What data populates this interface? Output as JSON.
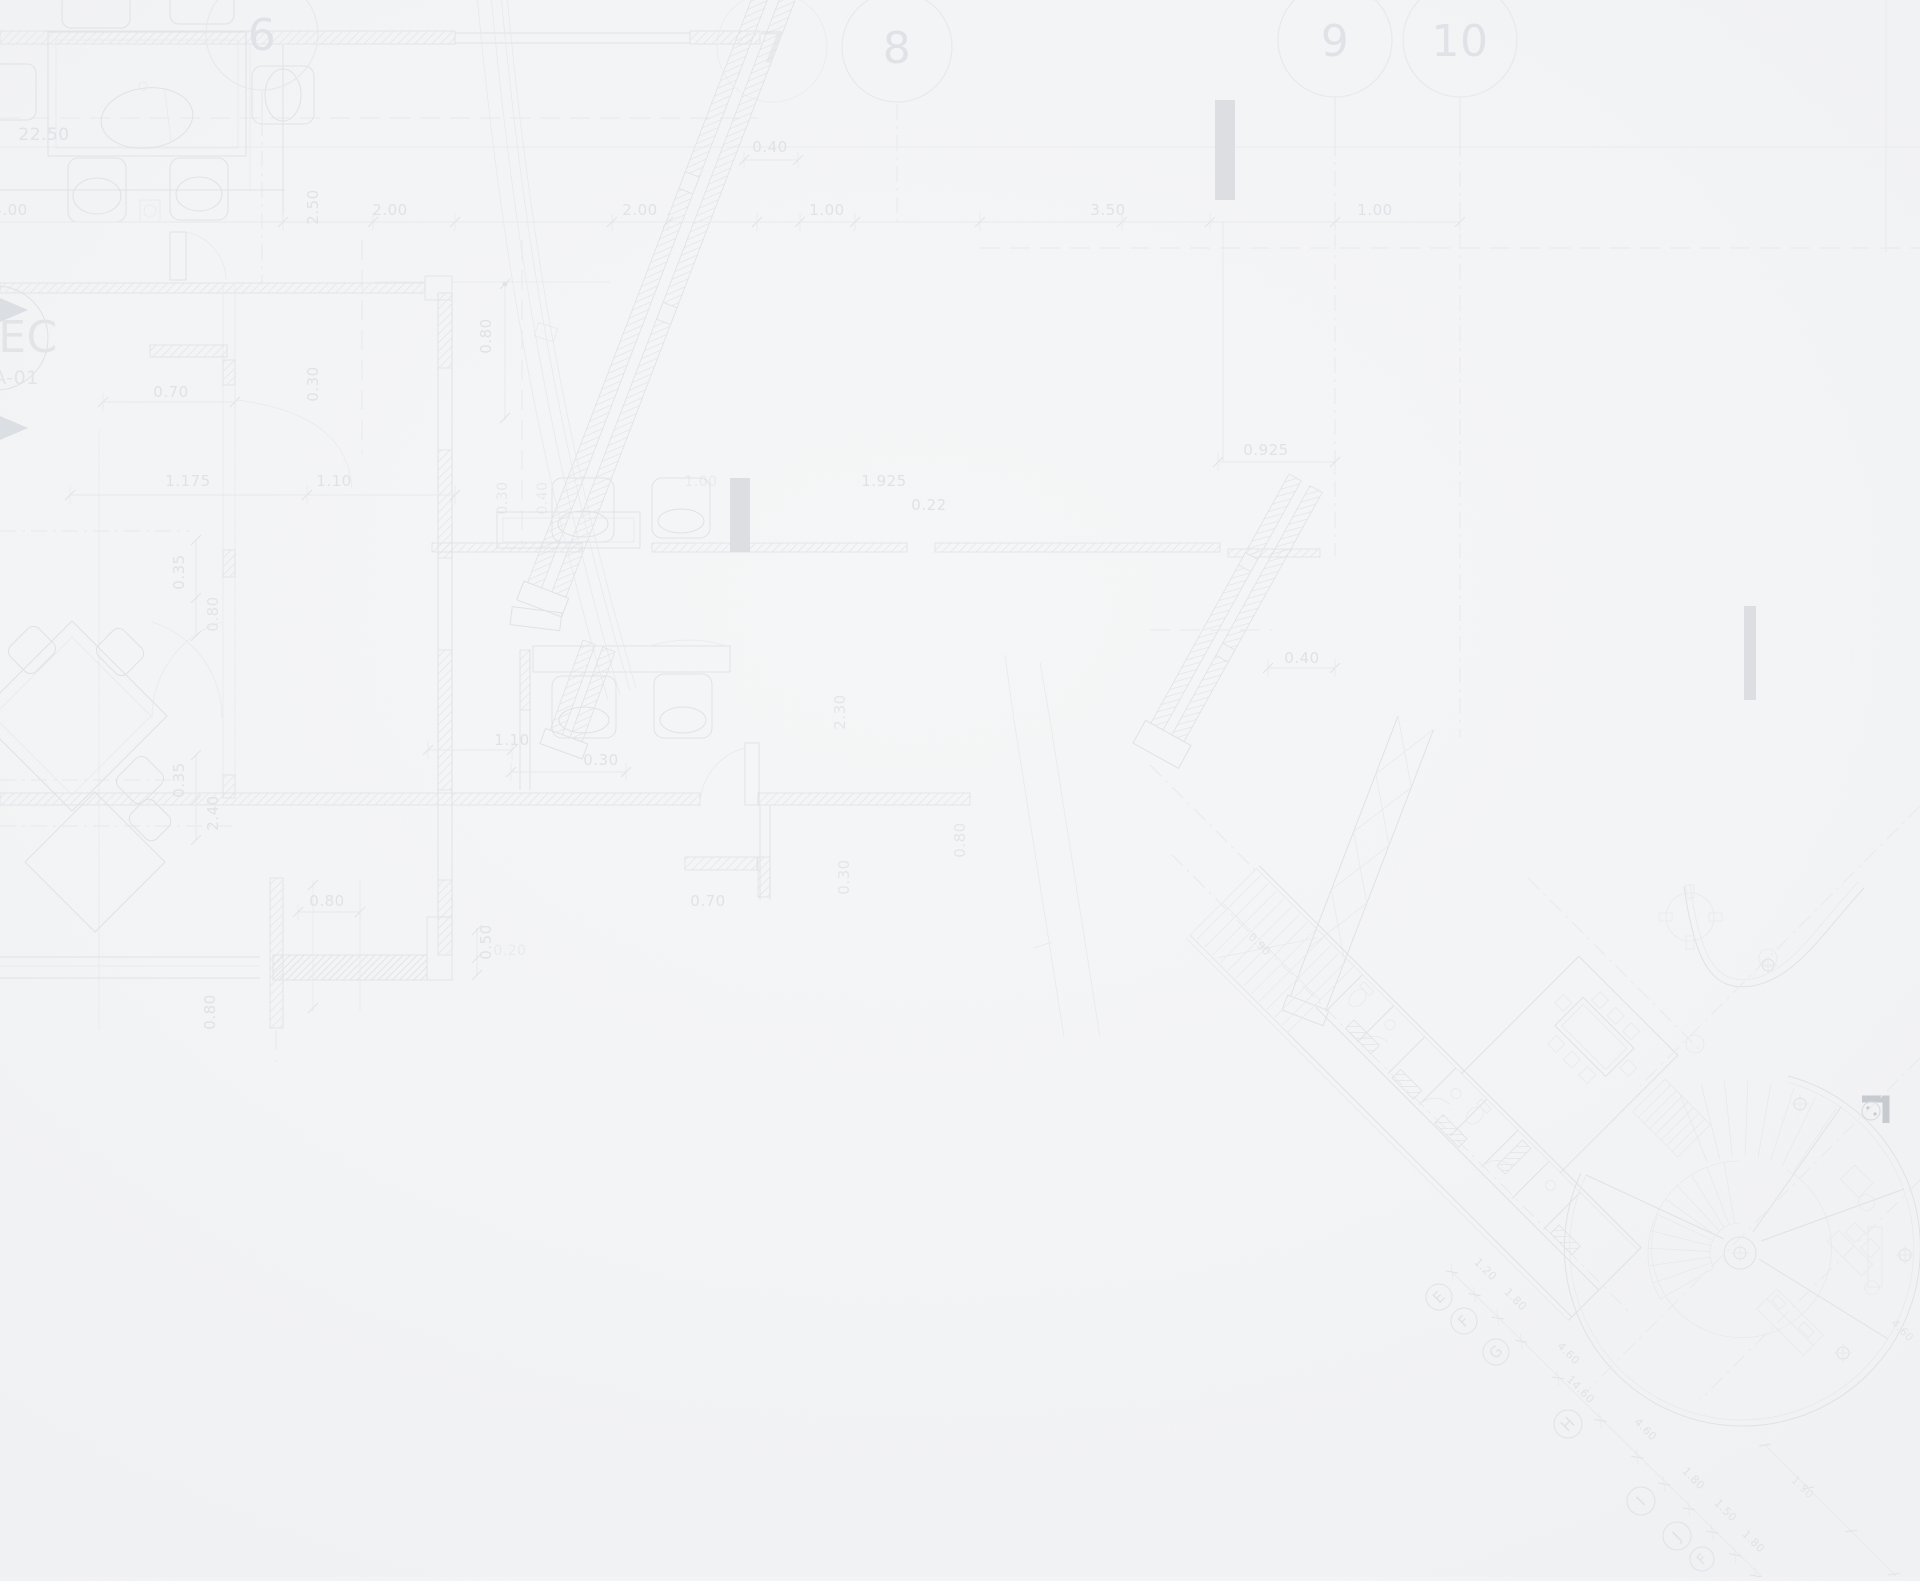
{
  "document": {
    "title": "Architectural floor plan blueprint background",
    "section_marker": {
      "line1": "EC",
      "line2": "A-01"
    }
  },
  "colors": {
    "background": "#f3f4f5",
    "line_light": "#e7e9ec",
    "line_mid": "#dfe2e6",
    "line_dark": "#d9dce0",
    "label": "#dfe2e6",
    "bar": "#dcdee2",
    "corner_mark": "#c7cacf"
  },
  "grid_bubbles_top": [
    {
      "label": "6",
      "x": 262,
      "y": 34,
      "r": 56,
      "fs": 44
    },
    {
      "label": "7",
      "x": 772,
      "y": 47,
      "r": 55,
      "fs": 44,
      "o": 0.55
    },
    {
      "label": "8",
      "x": 897,
      "y": 47,
      "r": 55,
      "fs": 44
    },
    {
      "label": "9",
      "x": 1335,
      "y": 40,
      "r": 57,
      "fs": 44
    },
    {
      "label": "10",
      "x": 1460,
      "y": 40,
      "r": 57,
      "fs": 44
    }
  ],
  "grid_bubbles_diagonal": [
    {
      "label": "E",
      "x": 1439,
      "y": 1297,
      "r": 13,
      "fs": 15
    },
    {
      "label": "F",
      "x": 1464,
      "y": 1321,
      "r": 13,
      "fs": 15
    },
    {
      "label": "G",
      "x": 1496,
      "y": 1352,
      "r": 13,
      "fs": 15
    },
    {
      "label": "H",
      "x": 1568,
      "y": 1424,
      "r": 14,
      "fs": 16
    },
    {
      "label": "I",
      "x": 1641,
      "y": 1501,
      "r": 14,
      "fs": 16
    },
    {
      "label": "J",
      "x": 1677,
      "y": 1536,
      "r": 14,
      "fs": 16
    },
    {
      "label": "F",
      "x": 1702,
      "y": 1559,
      "r": 12,
      "fs": 14
    }
  ],
  "dimension_labels": [
    {
      "t": "22.50",
      "x": 44,
      "y": 140,
      "s": 17
    },
    {
      "t": "4.00",
      "x": 10,
      "y": 215,
      "s": 15
    },
    {
      "t": "2.50",
      "x": 318,
      "y": 207,
      "s": 15,
      "r": -90
    },
    {
      "t": "2.00",
      "x": 390,
      "y": 215,
      "s": 15
    },
    {
      "t": "2.00",
      "x": 640,
      "y": 215,
      "s": 15
    },
    {
      "t": "1.00",
      "x": 827,
      "y": 215,
      "s": 15
    },
    {
      "t": "3.50",
      "x": 1108,
      "y": 215,
      "s": 15
    },
    {
      "t": "1.00",
      "x": 1375,
      "y": 215,
      "s": 15
    },
    {
      "t": "0.40",
      "x": 770,
      "y": 152,
      "s": 15
    },
    {
      "t": "0.70",
      "x": 171,
      "y": 397,
      "s": 15
    },
    {
      "t": "0.30",
      "x": 318,
      "y": 384,
      "s": 15,
      "r": -90
    },
    {
      "t": "0.80",
      "x": 491,
      "y": 336,
      "s": 15,
      "r": -90
    },
    {
      "t": "1.175",
      "x": 188,
      "y": 486,
      "s": 15
    },
    {
      "t": "1.10",
      "x": 334,
      "y": 486,
      "s": 15
    },
    {
      "t": "0.35",
      "x": 184,
      "y": 572,
      "s": 15,
      "r": -90
    },
    {
      "t": "0.80",
      "x": 218,
      "y": 614,
      "s": 15,
      "r": -90,
      "o": 0.85
    },
    {
      "t": "0.35",
      "x": 184,
      "y": 780,
      "s": 15,
      "r": -90
    },
    {
      "t": "2.40",
      "x": 218,
      "y": 813,
      "s": 15,
      "r": -90
    },
    {
      "t": "0.30",
      "x": 507,
      "y": 498,
      "s": 14,
      "r": -90,
      "o": 0.7
    },
    {
      "t": "0.40",
      "x": 547,
      "y": 498,
      "s": 14,
      "r": -90,
      "o": 0.6
    },
    {
      "t": "1.00",
      "x": 701,
      "y": 486,
      "s": 14,
      "o": 0.6
    },
    {
      "t": "1.10",
      "x": 512,
      "y": 745,
      "s": 15
    },
    {
      "t": "0.30",
      "x": 601,
      "y": 765,
      "s": 15
    },
    {
      "t": "2.30",
      "x": 845,
      "y": 712,
      "s": 15,
      "r": -90,
      "o": 0.8
    },
    {
      "t": "0.30",
      "x": 849,
      "y": 877,
      "s": 15,
      "r": -90,
      "o": 0.8
    },
    {
      "t": "0.80",
      "x": 965,
      "y": 840,
      "s": 15,
      "r": -90,
      "o": 0.8
    },
    {
      "t": "0.70",
      "x": 708,
      "y": 906,
      "s": 15
    },
    {
      "t": "0.80",
      "x": 327,
      "y": 906,
      "s": 15
    },
    {
      "t": "0.50",
      "x": 491,
      "y": 942,
      "s": 15,
      "r": -90
    },
    {
      "t": "0.20",
      "x": 510,
      "y": 955,
      "s": 14,
      "o": 0.55
    },
    {
      "t": "0.80",
      "x": 215,
      "y": 1012,
      "s": 15,
      "r": -90
    },
    {
      "t": "1.925",
      "x": 884,
      "y": 486,
      "s": 15
    },
    {
      "t": "0.22",
      "x": 929,
      "y": 510,
      "s": 15
    },
    {
      "t": "0.925",
      "x": 1266,
      "y": 455,
      "s": 15
    },
    {
      "t": "0.40",
      "x": 1302,
      "y": 663,
      "s": 15
    },
    {
      "t": "0.90",
      "x": 1257,
      "y": 947,
      "s": 11,
      "r": 45,
      "o": 0.8
    },
    {
      "t": "1.20",
      "x": 1483,
      "y": 1272,
      "s": 11,
      "r": 45
    },
    {
      "t": "1.80",
      "x": 1513,
      "y": 1302,
      "s": 11,
      "r": 45
    },
    {
      "t": "4.60",
      "x": 1566,
      "y": 1356,
      "s": 11,
      "r": 45
    },
    {
      "t": "14.60",
      "x": 1578,
      "y": 1392,
      "s": 11,
      "r": 45
    },
    {
      "t": "4.60",
      "x": 1643,
      "y": 1432,
      "s": 11,
      "r": 45
    },
    {
      "t": "1.80",
      "x": 1691,
      "y": 1481,
      "s": 11,
      "r": 45
    },
    {
      "t": "1.50",
      "x": 1723,
      "y": 1513,
      "s": 11,
      "r": 45
    },
    {
      "t": "1.80",
      "x": 1751,
      "y": 1544,
      "s": 11,
      "r": 45
    },
    {
      "t": "4.60",
      "x": 1900,
      "y": 1333,
      "s": 11,
      "r": 45,
      "o": 0.8
    },
    {
      "t": "1.50",
      "x": 1800,
      "y": 1490,
      "s": 11,
      "r": 45,
      "o": 0.8
    }
  ]
}
